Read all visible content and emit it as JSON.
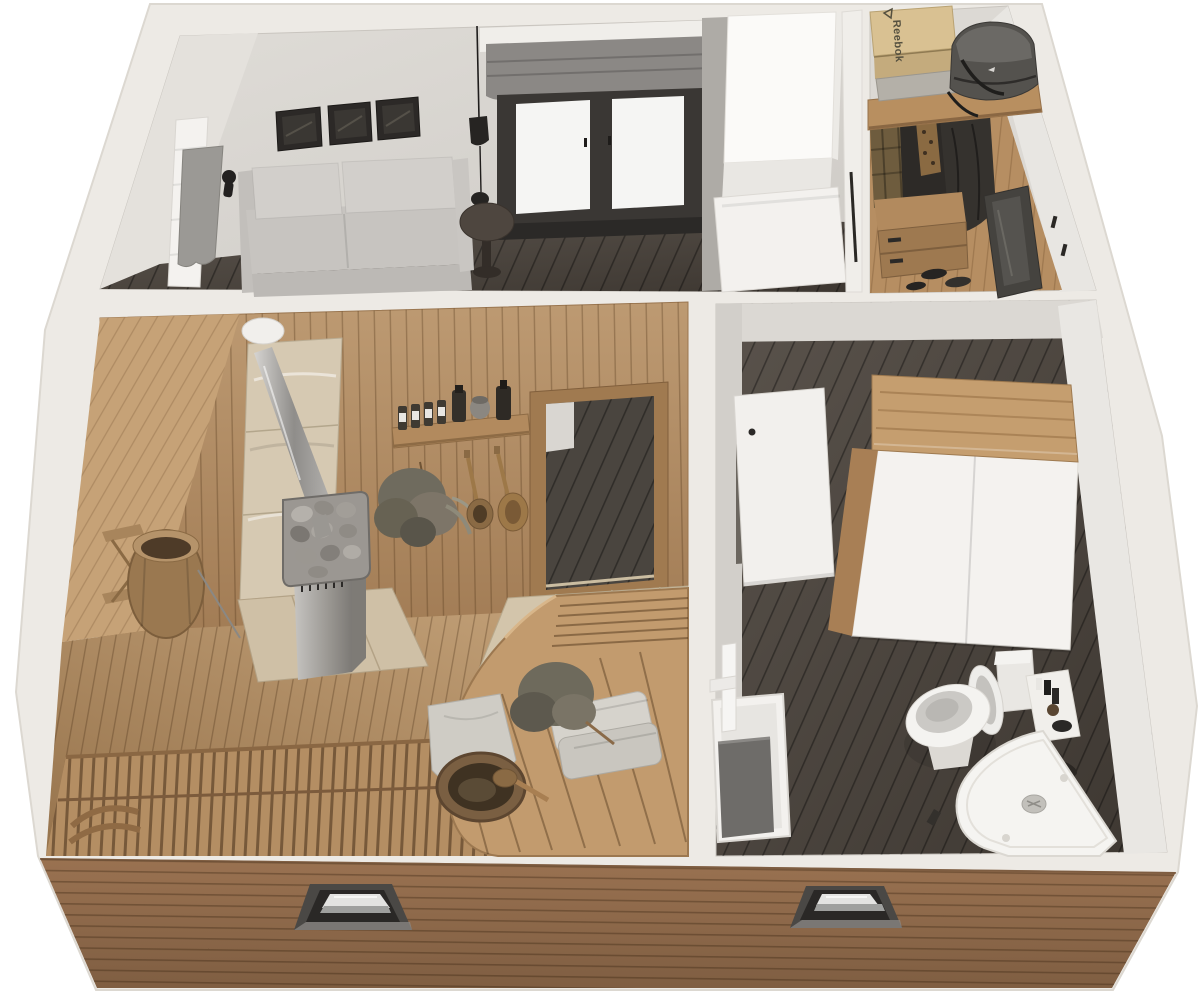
{
  "meta": {
    "title": "Isometric 3D cutaway floor-plan render of a sauna cabin",
    "view": "top-down dollhouse cutaway, photoreal render, transparent/white background",
    "canvas": {
      "width": 1200,
      "height": 992
    },
    "background": "#ffffff"
  },
  "palette": {
    "wall_cut_band": "#edeae5",
    "interior_wall_gray": "#d6d3ce",
    "interior_wall_light": "#e4e1dc",
    "dark_wood_floor": "#4d453e",
    "sauna_wall_wood": "#b3906a",
    "sauna_floor_wood": "#ab855d",
    "bench_wood": "#c29b6e",
    "stone_tile": "#d6c9b2",
    "facade_siding": "#916b4c",
    "metal": "#9a9792",
    "white_fixture": "#f4f2ef",
    "sofa_gray": "#cbc8c4",
    "shade_gray": "#8b8885",
    "duffel_gray": "#54524e"
  },
  "rooms": {
    "living_room": {
      "name": "living room",
      "objects": [
        "gray two-seat sofa",
        "three framed pictures",
        "window with gray roman shade",
        "black pendant lamp",
        "round side table",
        "towel radiator with gray towel",
        "black wall sconce",
        "dark wood plank floor"
      ]
    },
    "hallway": {
      "name": "entry hall",
      "objects": [
        "tall white cabinet",
        "gray partition wall",
        "leaning white door panel",
        "white closet door with long black pull"
      ]
    },
    "closet": {
      "name": "walk-in closet",
      "shoebox_brand": "Reebok",
      "objects": [
        "wood shelf board",
        "Reebok shoebox",
        "gray shoebox",
        "dark gray duffel bag",
        "clothes rail with white hangers",
        "plaid shirt",
        "dark coats",
        "patterned scarf",
        "wooden dresser with drawers",
        "shoes on floor",
        "leaning dark mirror",
        "wall hooks"
      ]
    },
    "sauna": {
      "name": "sauna",
      "objects": [
        "vertical wood plank walls",
        "sauna heater with stones",
        "stainless chimney pipe with white ceiling cap",
        "stone tile wall panel",
        "stone hearth pad",
        "wall shelf with oil bottles and jars",
        "hanging birch whisk",
        "wooden ladle and spoon on hooks",
        "door opening to hall with tiled threshold",
        "wall-mounted wooden bucket on bracket",
        "upper slatted bench",
        "curved tiered bench",
        "long duckboard bench",
        "bench headrest",
        "two folded towels",
        "birch whisk on bench",
        "draped cloth",
        "wooden bucket with ladle"
      ]
    },
    "bathroom": {
      "name": "bathroom",
      "objects": [
        "white storage cabinet with wood top",
        "open white door",
        "toilet with open lid and cistern",
        "corner shower tray with round drain",
        "utility sink with tall white faucet",
        "gray laundry insert",
        "white ledge with black toiletries",
        "dark slippers",
        "dark wood plank floor"
      ]
    },
    "exterior": {
      "name": "exterior shell",
      "objects": [
        "white cut-top walls",
        "brown horizontal wood siding facade",
        "left facade window (top view)",
        "right facade window (top view)"
      ]
    }
  }
}
